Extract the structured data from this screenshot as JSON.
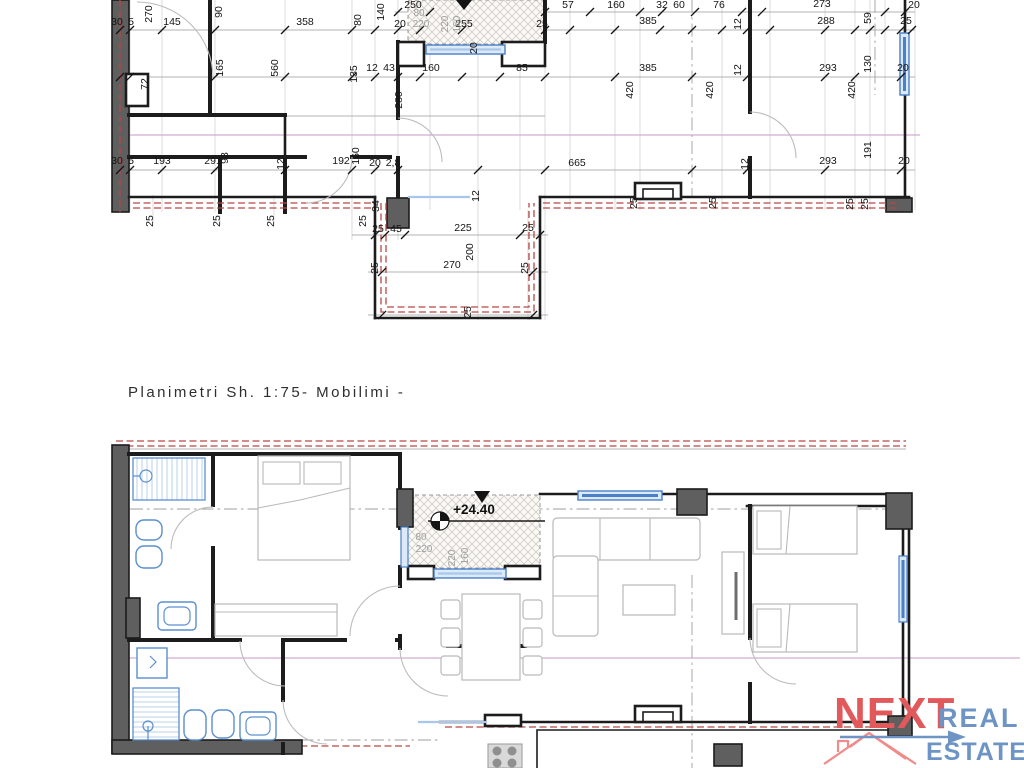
{
  "plan_document": {
    "title_scale": "Planimetri Sh. 1:75",
    "title_variant": "- Mobilimi -",
    "elevation_marker": "+24.40"
  },
  "upper_plan": {
    "kind": "dimensioned floor plan",
    "labels": [
      {
        "t": "30",
        "x": 117,
        "y": 25
      },
      {
        "t": "5",
        "x": 131,
        "y": 25
      },
      {
        "t": "270",
        "x": 152,
        "y": 14,
        "r": -90
      },
      {
        "t": "145",
        "x": 172,
        "y": 25
      },
      {
        "t": "90",
        "x": 222,
        "y": 12,
        "r": -90
      },
      {
        "t": "358",
        "x": 305,
        "y": 25
      },
      {
        "t": "80",
        "x": 361,
        "y": 20,
        "r": -90
      },
      {
        "t": "140",
        "x": 384,
        "y": 12,
        "r": -90
      },
      {
        "t": "250",
        "x": 413,
        "y": 8
      },
      {
        "t": "20",
        "x": 400,
        "y": 27
      },
      {
        "t": "255",
        "x": 464,
        "y": 27
      },
      {
        "t": "25",
        "x": 542,
        "y": 27
      },
      {
        "t": "57",
        "x": 568,
        "y": 8
      },
      {
        "t": "160",
        "x": 616,
        "y": 8
      },
      {
        "t": "32",
        "x": 662,
        "y": 8
      },
      {
        "t": "60",
        "x": 679,
        "y": 8
      },
      {
        "t": "76",
        "x": 719,
        "y": 8
      },
      {
        "t": "12",
        "x": 741,
        "y": 24,
        "r": -90
      },
      {
        "t": "273",
        "x": 822,
        "y": 7
      },
      {
        "t": "385",
        "x": 648,
        "y": 24
      },
      {
        "t": "288",
        "x": 826,
        "y": 24
      },
      {
        "t": "59",
        "x": 871,
        "y": 18,
        "r": -90
      },
      {
        "t": "25",
        "x": 906,
        "y": 24
      },
      {
        "t": "20",
        "x": 914,
        "y": 8
      },
      {
        "t": "72",
        "x": 148,
        "y": 84,
        "r": -90
      },
      {
        "t": "165",
        "x": 223,
        "y": 68,
        "r": -90
      },
      {
        "t": "560",
        "x": 278,
        "y": 68,
        "r": -90
      },
      {
        "t": "135",
        "x": 357,
        "y": 74,
        "r": -90
      },
      {
        "t": "12",
        "x": 372,
        "y": 71
      },
      {
        "t": "43",
        "x": 389,
        "y": 71
      },
      {
        "t": "160",
        "x": 431,
        "y": 71
      },
      {
        "t": "85",
        "x": 522,
        "y": 71
      },
      {
        "t": "385",
        "x": 648,
        "y": 71
      },
      {
        "t": "420",
        "x": 633,
        "y": 90,
        "r": -90
      },
      {
        "t": "420",
        "x": 713,
        "y": 90,
        "r": -90
      },
      {
        "t": "420",
        "x": 855,
        "y": 90,
        "r": -90
      },
      {
        "t": "293",
        "x": 828,
        "y": 71
      },
      {
        "t": "130",
        "x": 871,
        "y": 64,
        "r": -90
      },
      {
        "t": "20",
        "x": 903,
        "y": 71
      },
      {
        "t": "12",
        "x": 741,
        "y": 70,
        "r": -90
      },
      {
        "t": "20",
        "x": 477,
        "y": 48,
        "r": -90
      },
      {
        "t": "280",
        "x": 402,
        "y": 100,
        "r": -90
      },
      {
        "t": "80",
        "x": 419,
        "y": 16,
        "c": "g"
      },
      {
        "t": "220",
        "x": 421,
        "y": 27,
        "c": "g"
      },
      {
        "t": "160",
        "x": 460,
        "y": 24,
        "r": -90,
        "c": "g"
      },
      {
        "t": "220",
        "x": 448,
        "y": 24,
        "r": -90,
        "c": "g"
      },
      {
        "t": "30",
        "x": 117,
        "y": 164
      },
      {
        "t": "5",
        "x": 131,
        "y": 164
      },
      {
        "t": "193",
        "x": 162,
        "y": 164
      },
      {
        "t": "291",
        "x": 213,
        "y": 164
      },
      {
        "t": "93",
        "x": 228,
        "y": 158,
        "r": -90
      },
      {
        "t": "12",
        "x": 284,
        "y": 164,
        "r": -90
      },
      {
        "t": "192",
        "x": 341,
        "y": 164
      },
      {
        "t": "160",
        "x": 359,
        "y": 156,
        "r": -90
      },
      {
        "t": "20",
        "x": 375,
        "y": 166
      },
      {
        "t": "2,8",
        "x": 393,
        "y": 166
      },
      {
        "t": "665",
        "x": 577,
        "y": 166
      },
      {
        "t": "293",
        "x": 828,
        "y": 164
      },
      {
        "t": "191",
        "x": 871,
        "y": 150,
        "r": -90
      },
      {
        "t": "20",
        "x": 904,
        "y": 164
      },
      {
        "t": "12",
        "x": 748,
        "y": 164,
        "r": -90
      },
      {
        "t": "34",
        "x": 379,
        "y": 206,
        "r": -90
      },
      {
        "t": "25",
        "x": 366,
        "y": 221,
        "r": -90
      },
      {
        "t": "12",
        "x": 479,
        "y": 196,
        "r": -90
      },
      {
        "t": "25",
        "x": 378,
        "y": 232
      },
      {
        "t": "45",
        "x": 396,
        "y": 232
      },
      {
        "t": "225",
        "x": 463,
        "y": 231
      },
      {
        "t": "25",
        "x": 528,
        "y": 231
      },
      {
        "t": "200",
        "x": 473,
        "y": 252,
        "r": -90
      },
      {
        "t": "270",
        "x": 452,
        "y": 268
      },
      {
        "t": "25",
        "x": 378,
        "y": 268,
        "r": -90
      },
      {
        "t": "25",
        "x": 528,
        "y": 268,
        "r": -90
      },
      {
        "t": "25",
        "x": 471,
        "y": 312,
        "r": -90
      },
      {
        "t": "25",
        "x": 153,
        "y": 221,
        "r": -90
      },
      {
        "t": "25",
        "x": 220,
        "y": 221,
        "r": -90
      },
      {
        "t": "25",
        "x": 274,
        "y": 221,
        "r": -90
      },
      {
        "t": "25",
        "x": 637,
        "y": 203,
        "r": -90
      },
      {
        "t": "25",
        "x": 716,
        "y": 203,
        "r": -90
      },
      {
        "t": "25",
        "x": 853,
        "y": 204,
        "r": -90
      },
      {
        "t": "25",
        "x": 868,
        "y": 204,
        "r": -90
      }
    ]
  },
  "lower_plan": {
    "kind": "furnished floor plan (mobilimi)",
    "labels": [
      {
        "t": "+24.40",
        "x": 474,
        "y": 514,
        "c": "elev"
      },
      {
        "t": "80",
        "x": 421,
        "y": 540,
        "c": "g"
      },
      {
        "t": "220",
        "x": 424,
        "y": 552,
        "c": "g"
      },
      {
        "t": "160",
        "x": 468,
        "y": 556,
        "r": -90,
        "c": "g"
      },
      {
        "t": "220",
        "x": 455,
        "y": 558,
        "r": -90,
        "c": "g"
      }
    ]
  },
  "logo": {
    "brand_top": "NEXT",
    "brand_line1": "REAL",
    "brand_line2": "ESTATE",
    "accent_red": "#e2595c",
    "accent_blue": "#6d94c4"
  },
  "colors": {
    "wall": "#1c1c1c",
    "wall_fill": "#5f5f5f",
    "window_blue": "#4a7fc9",
    "railing_red": "#b84743",
    "section_pink": "#c79ac7",
    "furniture_gray": "#b9b9b9",
    "fixture_blue": "#5a8fd0",
    "dim_text": "#141414",
    "gray_label": "#9e9e9e"
  }
}
